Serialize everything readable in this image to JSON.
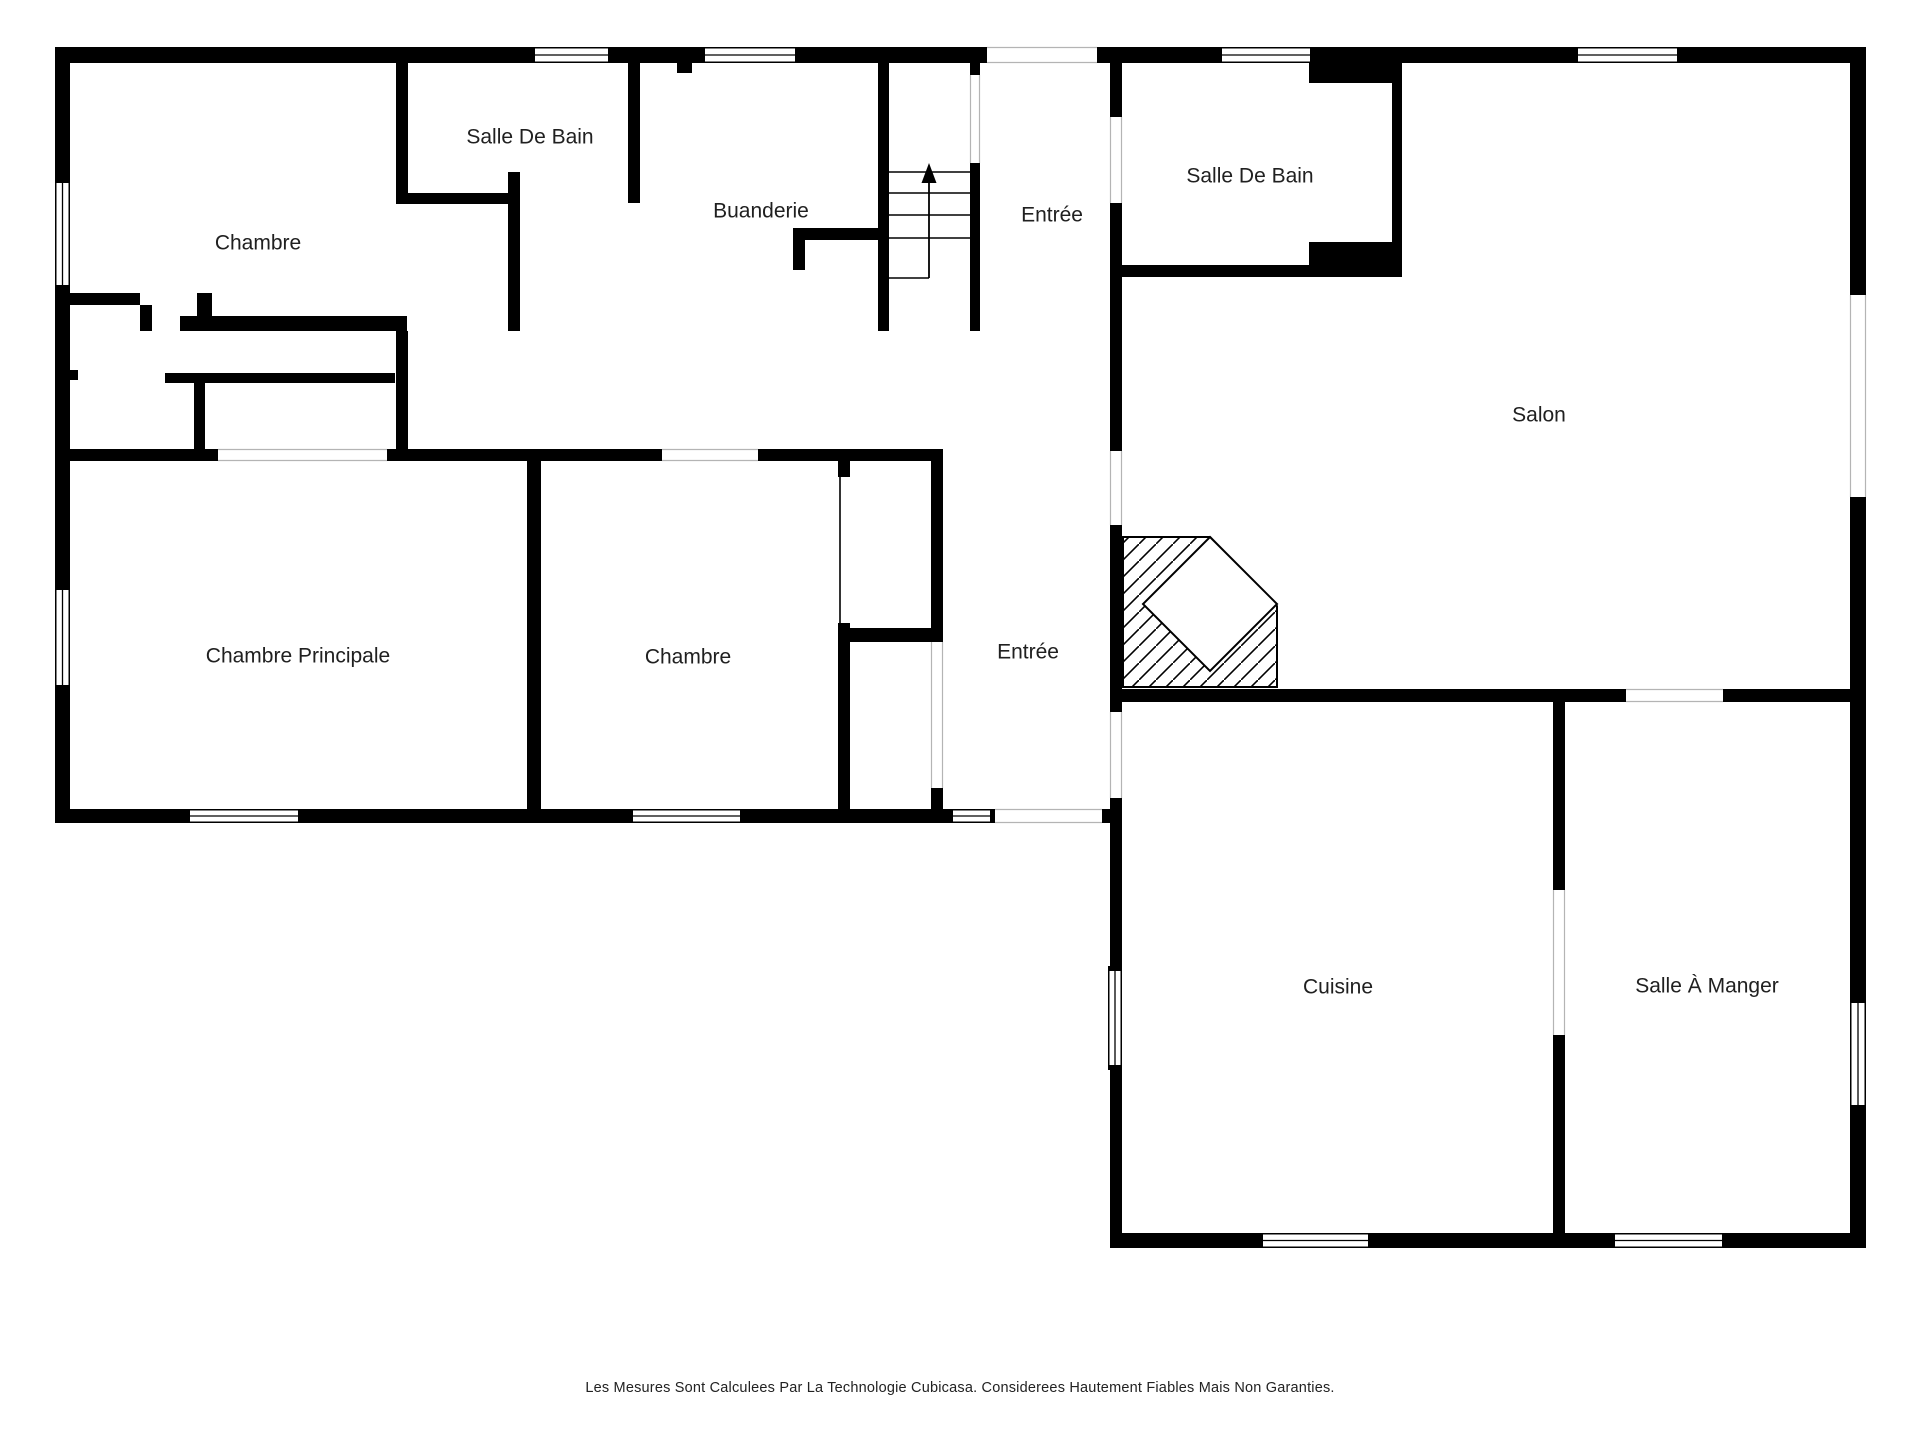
{
  "meta": {
    "canvas_width": 1920,
    "canvas_height": 1440,
    "background_color": "#ffffff",
    "wall_color": "#000000",
    "label_color": "#202020",
    "label_font_size": 21,
    "opening_rail_color": "#b4b4b4",
    "thin_line_color": "#000000"
  },
  "rooms": [
    {
      "id": "chambre-haut",
      "label": "Chambre",
      "cx": 258,
      "cy": 243
    },
    {
      "id": "salle-de-bain-haut",
      "label": "Salle De Bain",
      "cx": 530,
      "cy": 137
    },
    {
      "id": "buanderie",
      "label": "Buanderie",
      "cx": 761,
      "cy": 211
    },
    {
      "id": "entree-haut",
      "label": "Entrée",
      "cx": 1052,
      "cy": 215
    },
    {
      "id": "salle-de-bain-droite",
      "label": "Salle De Bain",
      "cx": 1250,
      "cy": 176
    },
    {
      "id": "salon",
      "label": "Salon",
      "cx": 1539,
      "cy": 415
    },
    {
      "id": "chambre-principale",
      "label": "Chambre Principale",
      "cx": 298,
      "cy": 656
    },
    {
      "id": "chambre-bas",
      "label": "Chambre",
      "cx": 688,
      "cy": 657
    },
    {
      "id": "entree-bas",
      "label": "Entrée",
      "cx": 1028,
      "cy": 652
    },
    {
      "id": "cuisine",
      "label": "Cuisine",
      "cx": 1338,
      "cy": 987
    },
    {
      "id": "salle-a-manger",
      "label": "Salle À Manger",
      "cx": 1707,
      "cy": 986
    }
  ],
  "walls": [
    [
      55,
      47,
      475,
      16
    ],
    [
      613,
      47,
      87,
      16
    ],
    [
      800,
      47,
      187,
      16
    ],
    [
      1097,
      47,
      120,
      16
    ],
    [
      1315,
      47,
      258,
      16
    ],
    [
      1682,
      47,
      184,
      16
    ],
    [
      55,
      47,
      15,
      131
    ],
    [
      55,
      290,
      15,
      295
    ],
    [
      55,
      690,
      15,
      133
    ],
    [
      1850,
      47,
      16,
      248
    ],
    [
      1850,
      497,
      16,
      501
    ],
    [
      1850,
      1110,
      16,
      138
    ],
    [
      55,
      809,
      130,
      14
    ],
    [
      303,
      809,
      325,
      14
    ],
    [
      745,
      809,
      203,
      14
    ],
    [
      1102,
      809,
      20,
      14
    ],
    [
      1110,
      798,
      12,
      168
    ],
    [
      1110,
      1070,
      12,
      178
    ],
    [
      1110,
      1233,
      148,
      15
    ],
    [
      1373,
      1233,
      237,
      15
    ],
    [
      1727,
      1233,
      139,
      15
    ],
    [
      1110,
      63,
      12,
      54
    ],
    [
      1110,
      203,
      12,
      248
    ],
    [
      1110,
      525,
      12,
      187
    ],
    [
      1122,
      265,
      280,
      12
    ],
    [
      1309,
      242,
      93,
      23
    ],
    [
      1392,
      83,
      10,
      182
    ],
    [
      1309,
      63,
      93,
      20
    ],
    [
      1122,
      689,
      504,
      13
    ],
    [
      1723,
      689,
      127,
      13
    ],
    [
      396,
      63,
      12,
      141
    ],
    [
      396,
      193,
      123,
      11
    ],
    [
      508,
      172,
      12,
      159
    ],
    [
      628,
      63,
      12,
      140
    ],
    [
      793,
      228,
      96,
      12
    ],
    [
      793,
      240,
      12,
      30
    ],
    [
      878,
      63,
      11,
      268
    ],
    [
      970,
      63,
      10,
      12
    ],
    [
      970,
      163,
      10,
      168
    ],
    [
      677,
      63,
      15,
      10
    ],
    [
      55,
      293,
      85,
      12
    ],
    [
      140,
      305,
      12,
      26
    ],
    [
      197,
      293,
      15,
      38
    ],
    [
      180,
      316,
      227,
      15
    ],
    [
      165,
      373,
      230,
      10
    ],
    [
      55,
      370,
      23,
      10
    ],
    [
      194,
      383,
      11,
      66
    ],
    [
      396,
      331,
      12,
      130
    ],
    [
      55,
      449,
      163,
      12
    ],
    [
      387,
      449,
      275,
      12
    ],
    [
      758,
      449,
      185,
      12
    ],
    [
      527,
      461,
      14,
      348
    ],
    [
      838,
      461,
      12,
      16
    ],
    [
      838,
      623,
      12,
      186
    ],
    [
      850,
      628,
      82,
      14
    ],
    [
      931,
      461,
      12,
      181
    ],
    [
      931,
      788,
      12,
      21
    ],
    [
      1553,
      701,
      12,
      189
    ],
    [
      1553,
      1035,
      12,
      213
    ]
  ],
  "windows": [
    {
      "rect": [
        530,
        47,
        83,
        16
      ],
      "axis": "h"
    },
    {
      "rect": [
        700,
        47,
        100,
        16
      ],
      "axis": "h"
    },
    {
      "rect": [
        1217,
        47,
        98,
        16
      ],
      "axis": "h"
    },
    {
      "rect": [
        1573,
        47,
        109,
        16
      ],
      "axis": "h"
    },
    {
      "rect": [
        55,
        178,
        15,
        112
      ],
      "axis": "v"
    },
    {
      "rect": [
        55,
        585,
        15,
        105
      ],
      "axis": "v"
    },
    {
      "rect": [
        185,
        809,
        118,
        14
      ],
      "axis": "h"
    },
    {
      "rect": [
        628,
        809,
        117,
        14
      ],
      "axis": "h"
    },
    {
      "rect": [
        1108,
        966,
        14,
        104
      ],
      "axis": "v"
    },
    {
      "rect": [
        1258,
        1233,
        115,
        15
      ],
      "axis": "h"
    },
    {
      "rect": [
        1610,
        1233,
        117,
        15
      ],
      "axis": "h"
    },
    {
      "rect": [
        1850,
        998,
        16,
        112
      ],
      "axis": "v"
    }
  ],
  "door": {
    "rect": [
      948,
      809,
      47,
      14
    ],
    "axis": "h"
  },
  "openings": [
    {
      "rect": [
        987,
        47,
        110,
        16
      ],
      "axis": "h"
    },
    {
      "rect": [
        1850,
        295,
        16,
        202
      ],
      "axis": "v"
    },
    {
      "rect": [
        1110,
        117,
        12,
        86
      ],
      "axis": "v"
    },
    {
      "rect": [
        1110,
        451,
        12,
        74
      ],
      "axis": "v"
    },
    {
      "rect": [
        1110,
        712,
        12,
        86
      ],
      "axis": "v"
    },
    {
      "rect": [
        218,
        449,
        169,
        12
      ],
      "axis": "h"
    },
    {
      "rect": [
        662,
        449,
        96,
        12
      ],
      "axis": "h"
    },
    {
      "rect": [
        931,
        642,
        12,
        146
      ],
      "axis": "v"
    },
    {
      "rect": [
        1626,
        689,
        97,
        13
      ],
      "axis": "h"
    },
    {
      "rect": [
        1553,
        890,
        12,
        145
      ],
      "axis": "v"
    },
    {
      "rect": [
        995,
        809,
        107,
        14
      ],
      "axis": "h"
    },
    {
      "rect": [
        970,
        75,
        10,
        88
      ],
      "axis": "v"
    }
  ],
  "closet_door": {
    "rect": [
      838,
      477,
      12,
      146
    ],
    "axis": "v"
  },
  "stairs": {
    "left": 889,
    "right": 970,
    "treads_y": [
      172,
      193,
      215,
      238
    ],
    "half_tread": {
      "x1": 889,
      "x2": 929,
      "y": 278
    },
    "arrow": {
      "x": 929,
      "y_bottom": 278,
      "y_top": 181,
      "head_tip_y": 163,
      "head_half_width": 7.5,
      "head_base_y": 183
    }
  },
  "fireplace": {
    "outline": [
      [
        1123,
        537
      ],
      [
        1210,
        537
      ],
      [
        1277,
        606
      ],
      [
        1277,
        687
      ],
      [
        1123,
        687
      ]
    ],
    "diamond": [
      [
        1210,
        537
      ],
      [
        1277,
        604
      ],
      [
        1210,
        671
      ],
      [
        1143,
        604
      ]
    ],
    "hatch_spacing": 17
  },
  "footer": {
    "text": "Les Mesures Sont Calculees Par La Technologie Cubicasa. Considerees Hautement Fiables Mais Non Garanties."
  }
}
